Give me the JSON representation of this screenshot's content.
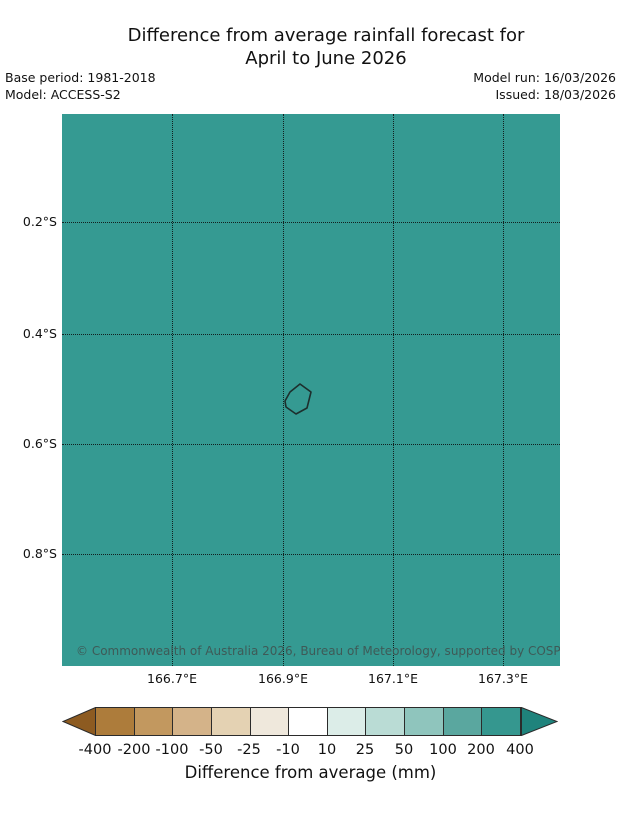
{
  "header": {
    "title_line1": "Difference from average rainfall forecast for",
    "title_line2": "April to June 2026",
    "base_period": "Base period: 1981-2018",
    "model": "Model: ACCESS-S2",
    "model_run": "Model run: 16/03/2026",
    "issued": "Issued: 18/03/2026"
  },
  "map": {
    "fill_color": "#359a92",
    "copyright": "© Commonwealth of Australia 2026, Bureau of Meteorology, supported by COSPPac",
    "y_ticks": [
      "0.2°S",
      "0.4°S",
      "0.6°S",
      "0.8°S"
    ],
    "x_ticks": [
      "166.7°E",
      "166.9°E",
      "167.1°E",
      "167.3°E"
    ]
  },
  "colorbar": {
    "label": "Difference from average (mm)",
    "ticks": [
      "-400",
      "-200",
      "-100",
      "-50",
      "-25",
      "-10",
      "10",
      "25",
      "50",
      "100",
      "200",
      "400"
    ],
    "colors": [
      "#8d5b21",
      "#ad7c3b",
      "#c2985f",
      "#d4b389",
      "#e4d2b3",
      "#efe8dc",
      "#ffffff",
      "#dcede8",
      "#badcd5",
      "#8fc5bd",
      "#5aa79f",
      "#35978f",
      "#1f837c"
    ]
  },
  "chart_data": {
    "type": "heatmap",
    "title": "Difference from average rainfall forecast for April to June 2026",
    "base_period": "1981-2018",
    "model": "ACCESS-S2",
    "model_run": "16/03/2026",
    "issued": "18/03/2026",
    "x_ticks": [
      "166.7°E",
      "166.9°E",
      "167.1°E",
      "167.3°E"
    ],
    "y_ticks": [
      "0.2°S",
      "0.4°S",
      "0.6°S",
      "0.8°S"
    ],
    "colorbar_label": "Difference from average (mm)",
    "colorbar_boundaries": [
      -400,
      -200,
      -100,
      -50,
      -25,
      -10,
      10,
      25,
      50,
      100,
      200,
      400
    ],
    "map_uniform_value_bin": "200 to 400 mm above average",
    "feature": "Nauru island coastline outline near 166.93°E, 0.52°S",
    "grid": true,
    "attribution": "© Commonwealth of Australia 2026, Bureau of Meteorology, supported by COSPPac"
  }
}
